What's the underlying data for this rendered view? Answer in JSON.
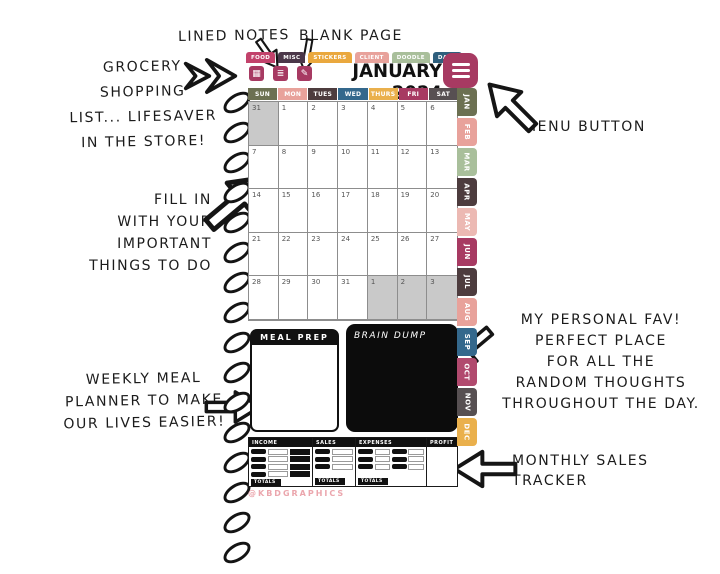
{
  "watermark": "@KBDGRAPHICS",
  "annotations": {
    "lined_notes": "LINED NOTES",
    "blank_page": "BLANK PAGE",
    "grocery": [
      "GROCERY",
      "SHOPPING",
      "LIST... LIFESAVER",
      "IN THE STORE!"
    ],
    "menu": "MENU BUTTON",
    "fill_in": [
      "FILL IN",
      "WITH YOUR",
      "IMPORTANT",
      "THINGS TO DO"
    ],
    "personal_fav": [
      "MY PERSONAL FAV!",
      "PERFECT PLACE",
      "FOR ALL THE",
      "RANDOM THOUGHTS",
      "THROUGHOUT THE DAY."
    ],
    "weekly_meal": [
      "WEEKLY MEAL",
      "PLANNER TO MAKE",
      "OUR LIVES EASIER!"
    ],
    "monthly_sales": [
      "MONTHLY SALES",
      "TRACKER"
    ]
  },
  "planner": {
    "title": "JANUARY 2024",
    "accent_color": "#a73a62",
    "top_tabs": [
      {
        "label": "FOOD",
        "color": "#c2426b"
      },
      {
        "label": "MISC",
        "color": "#4b3749"
      },
      {
        "label": "STICKERS",
        "color": "#eaa83e"
      },
      {
        "label": "CLIENT",
        "color": "#e8a29b"
      },
      {
        "label": "DOODLE",
        "color": "#a9bf9b"
      },
      {
        "label": "DAILY",
        "color": "#2e5f7d"
      }
    ],
    "toolbar": {
      "color": "#a73a62",
      "grid_icon": "▦",
      "lined_icon": "≣",
      "blank_icon": "✎"
    },
    "weekdays": [
      {
        "label": "SUN",
        "color": "#6c7052"
      },
      {
        "label": "MON",
        "color": "#e8a29b"
      },
      {
        "label": "TUES",
        "color": "#4d3c3e"
      },
      {
        "label": "WED",
        "color": "#34688c"
      },
      {
        "label": "THURS",
        "color": "#eab04c"
      },
      {
        "label": "FRI",
        "color": "#a73a62"
      },
      {
        "label": "SAT",
        "color": "#575052"
      }
    ],
    "weeks": [
      [
        "31",
        "1",
        "2",
        "3",
        "4",
        "5",
        "6"
      ],
      [
        "7",
        "8",
        "9",
        "10",
        "11",
        "12",
        "13"
      ],
      [
        "14",
        "15",
        "16",
        "17",
        "18",
        "19",
        "20"
      ],
      [
        "21",
        "22",
        "23",
        "24",
        "25",
        "26",
        "27"
      ],
      [
        "28",
        "29",
        "30",
        "31",
        "1",
        "2",
        "3"
      ]
    ],
    "meal_prep_title": "MEAL PREP",
    "brain_dump_title": "BRAIN DUMP",
    "tracker": {
      "columns": [
        "INCOME",
        "SALES",
        "EXPENSES",
        "PROFIT"
      ],
      "totals_label": "TOTALS"
    },
    "month_tabs": [
      {
        "label": "JAN",
        "color": "#6c7052"
      },
      {
        "label": "FEB",
        "color": "#e8a29b"
      },
      {
        "label": "MAR",
        "color": "#a9bf9b"
      },
      {
        "label": "APR",
        "color": "#4d3c3e"
      },
      {
        "label": "MAY",
        "color": "#ecb9b3"
      },
      {
        "label": "JUN",
        "color": "#a73a62"
      },
      {
        "label": "JUL",
        "color": "#4d3c3e"
      },
      {
        "label": "AUG",
        "color": "#e8a29b"
      },
      {
        "label": "SEP",
        "color": "#34688c"
      },
      {
        "label": "OCT",
        "color": "#b14a6e"
      },
      {
        "label": "NOV",
        "color": "#575052"
      },
      {
        "label": "DEC",
        "color": "#eab04c"
      }
    ]
  }
}
